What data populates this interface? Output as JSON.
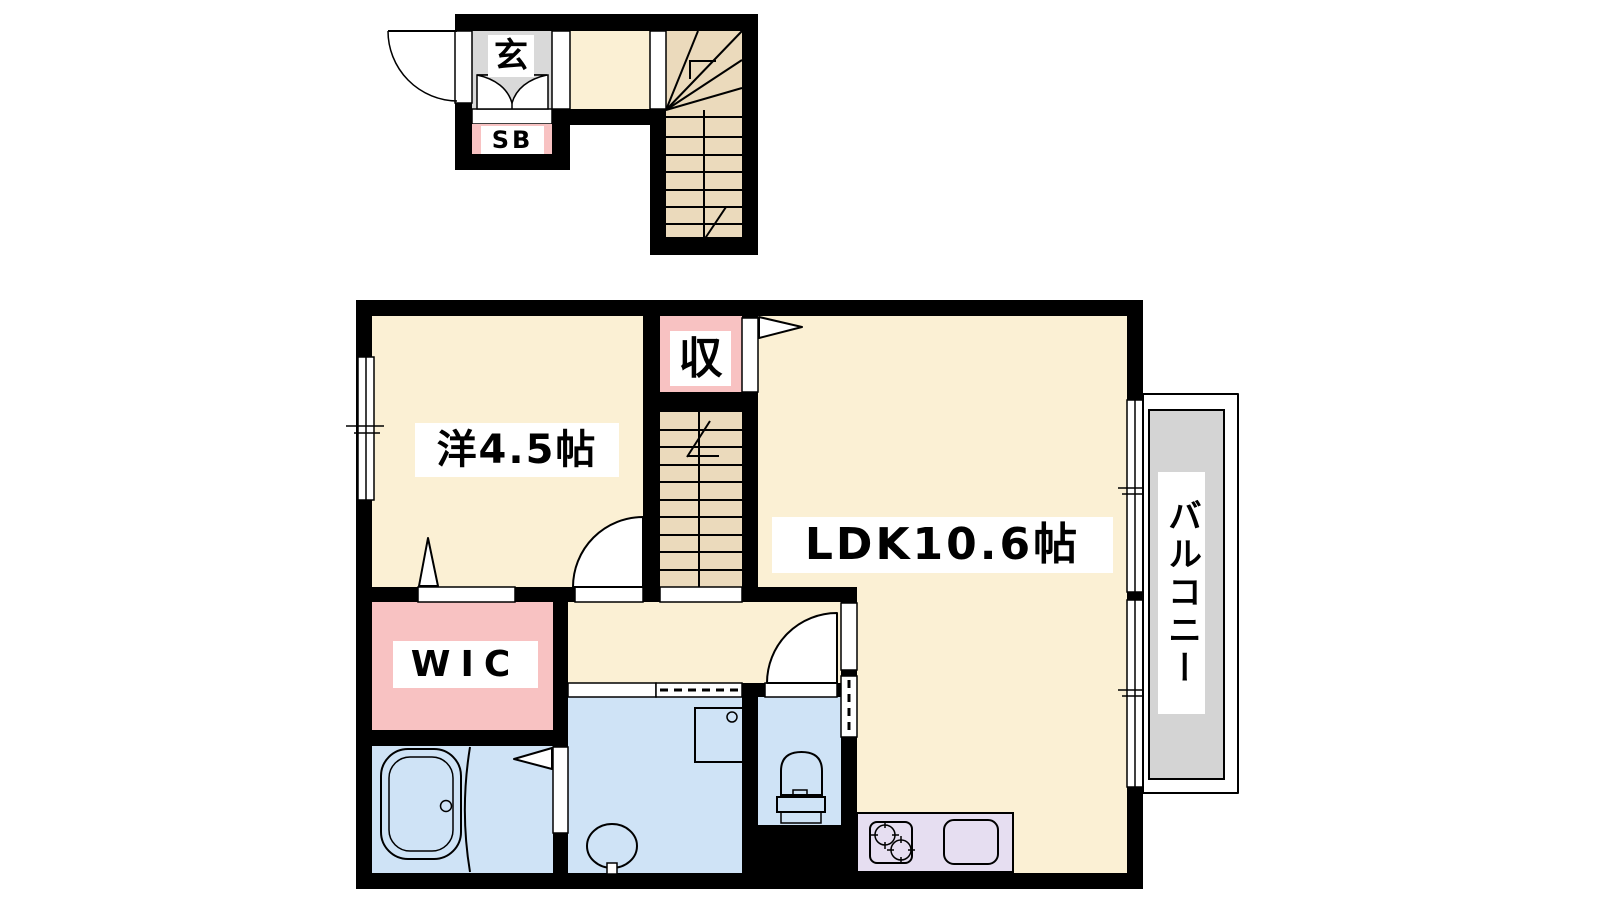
{
  "colors": {
    "room_cream": "#fbf0d4",
    "stair_tan": "#ebdabc",
    "accent_pink": "#f8c2c2",
    "wet_blue": "#cfe3f6",
    "kitchen_lavender": "#e6def1",
    "entrance_gray": "#d9d9d9",
    "balcony_gray": "#d4d4d4",
    "wall": "#000000"
  },
  "rooms": {
    "entrance": {
      "label": "玄"
    },
    "shoe_box": {
      "label": "SB"
    },
    "western_room": {
      "label": "洋4.5帖",
      "size_jo": 4.5
    },
    "storage": {
      "label": "収"
    },
    "ldk": {
      "label": "LDK10.6帖",
      "size_jo": 10.6
    },
    "walk_in_closet": {
      "label": "WIC"
    },
    "balcony": {
      "label": "バルコニー"
    }
  },
  "fixtures": [
    "entrance-door",
    "staircase-entrance",
    "staircase-main",
    "bathtub",
    "wash-basin",
    "washing-machine-pan",
    "toilet",
    "gas-stove",
    "kitchen-sink",
    "sliding-window",
    "hinged-door",
    "balcony"
  ]
}
